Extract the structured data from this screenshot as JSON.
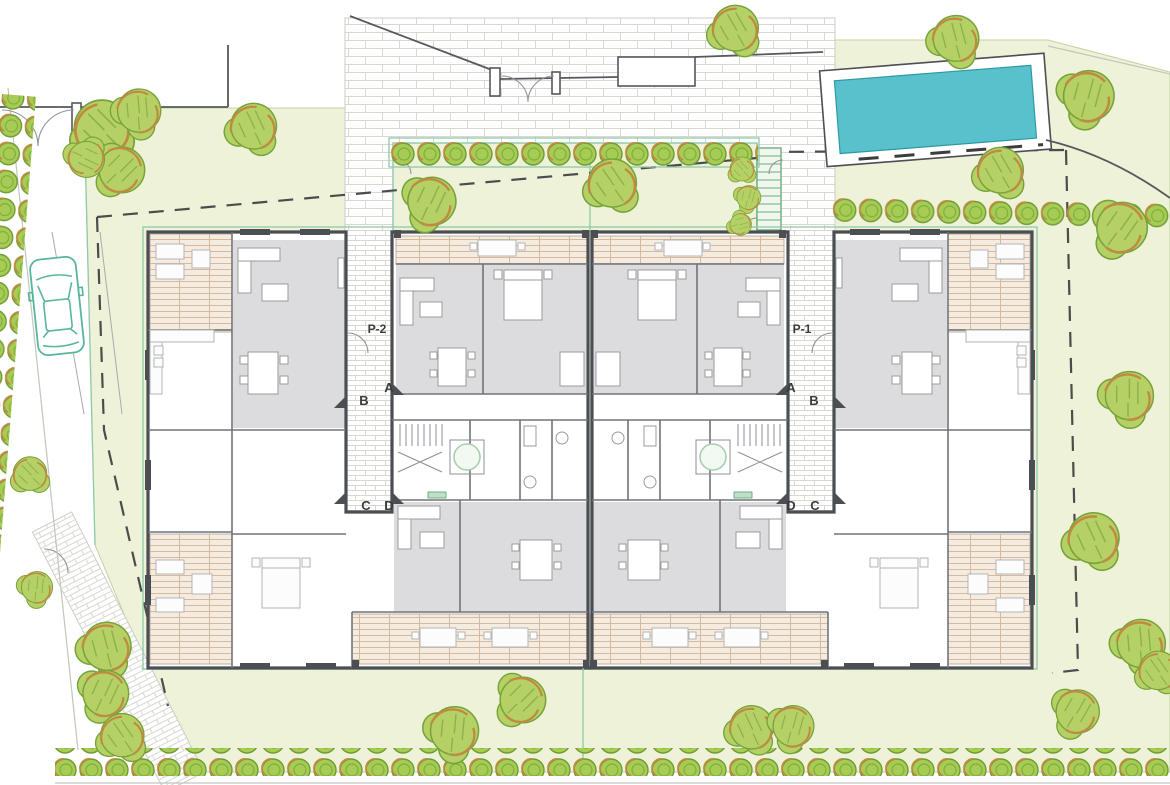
{
  "plan": {
    "type": "residential-site-plan-ground-floor",
    "labels": {
      "p2": "P-2",
      "p1": "P-1",
      "left": {
        "a": "A",
        "b": "B",
        "c": "C",
        "d": "D"
      },
      "right": {
        "a": "A",
        "b": "B",
        "c": "C",
        "d": "D"
      }
    }
  },
  "colors": {
    "lawn": "#edf2d8",
    "lawn_edge": "#c3d49c",
    "green_line": "#8fc9a8",
    "pool_water": "#58c1cc",
    "pool_hatch": "#8ad9de",
    "pool_edge": "#2e99a5",
    "tree_fill": "#b5d165",
    "tree_stroke": "#76a23a",
    "tree_accent": "#c18a43",
    "bush_fill": "#a6cc55",
    "bush_stroke": "#6f9a33",
    "wall": "#4b4e52",
    "wall_mid": "#70747a",
    "room_gray": "#dcdcde",
    "deck_line": "#d9b99c",
    "brick_line": "#d8d8d0",
    "dash": "#4c4c4c",
    "fence": "#55585c",
    "car": "#57b79c",
    "stair_green": "#6aae7e",
    "elevator": "#a8cfae",
    "mat": "#bfe0c8",
    "furn_stroke": "#9b9b9b",
    "label": "#3b3b3b"
  }
}
